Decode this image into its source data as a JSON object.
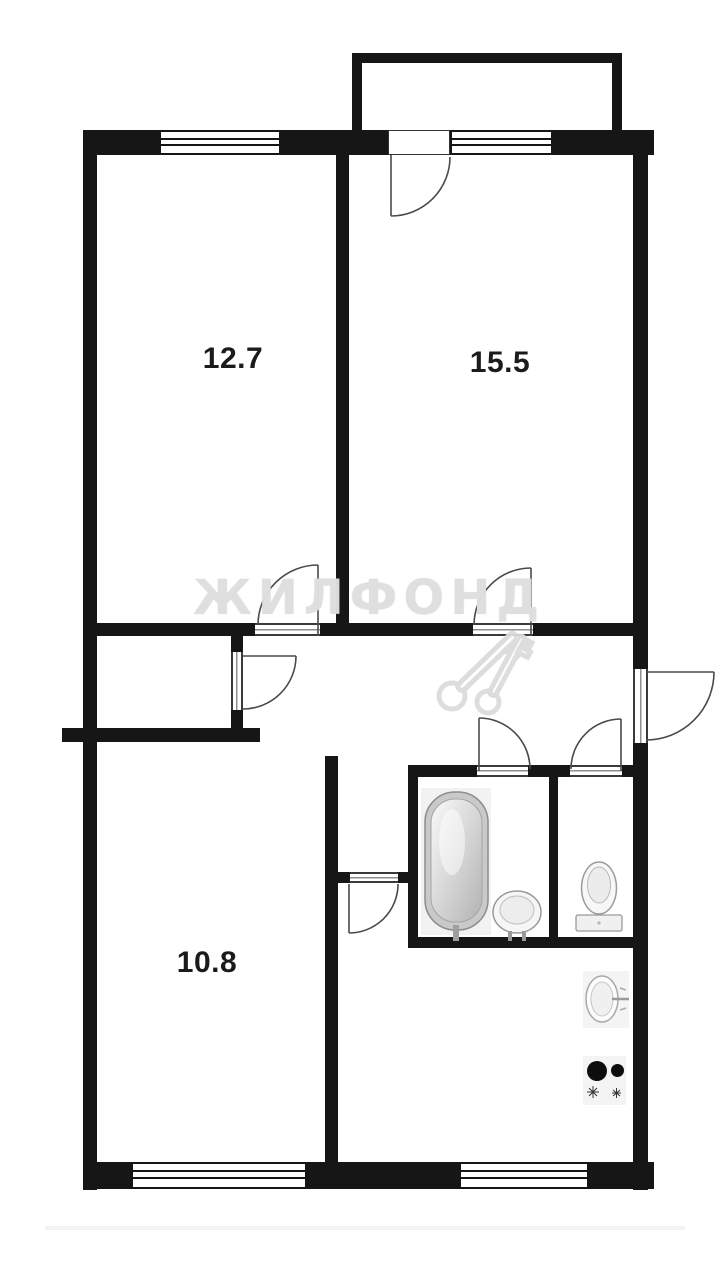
{
  "document": {
    "type": "apartment floor plan"
  },
  "rooms": [
    {
      "label": "12.7"
    },
    {
      "label": "15.5"
    },
    {
      "label": "10.8"
    }
  ],
  "watermark": {
    "text": "ЖИЛФОНД"
  },
  "colors": {
    "background": "#ffffff",
    "wall": "#161616",
    "door_arc": "#4a4a4a",
    "room_label": "#1b1b1b",
    "watermark": "#dedede",
    "fixture_outline": "#9a9a9a"
  },
  "fixtures": [
    {
      "name": "bathtub"
    },
    {
      "name": "bathroom-sink"
    },
    {
      "name": "toilet"
    },
    {
      "name": "kitchen-sink"
    },
    {
      "name": "stove-2-burner"
    }
  ]
}
